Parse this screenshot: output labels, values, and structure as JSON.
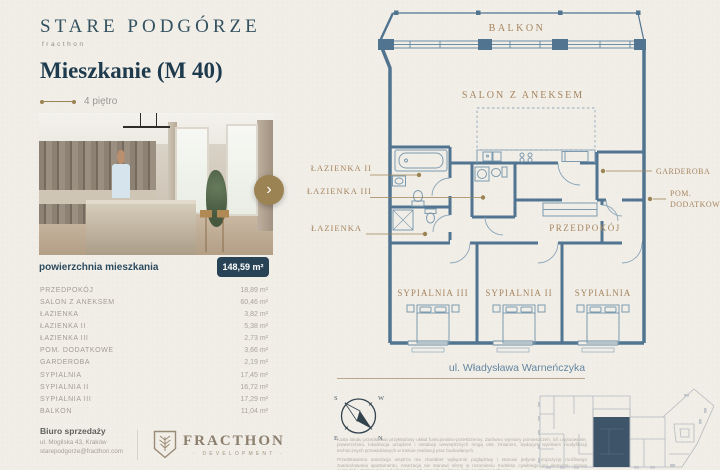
{
  "brand": {
    "name": "STARE PODGÓRZE",
    "sub": "fracthon"
  },
  "header": {
    "title": "Mieszkanie (M 40)",
    "floor": "4 piętro"
  },
  "gallery": {
    "next_icon": "›"
  },
  "area_summary": {
    "label": "powierzchnia mieszkania",
    "value": "148,59 m²"
  },
  "rooms": [
    {
      "name": "PRZEDPOKÓJ",
      "area": "18,89 m²"
    },
    {
      "name": "SALON Z ANEKSEM",
      "area": "60,46 m²"
    },
    {
      "name": "ŁAZIENKA",
      "area": "3,82 m²"
    },
    {
      "name": "ŁAZIENKA II",
      "area": "5,38 m²"
    },
    {
      "name": "ŁAZIENKA III",
      "area": "2,73 m²"
    },
    {
      "name": "POM. DODATKOWE",
      "area": "3,66 m²"
    },
    {
      "name": "GARDEROBA",
      "area": "2,19 m²"
    },
    {
      "name": "SYPIALNIA",
      "area": "17,45 m²"
    },
    {
      "name": "SYPIALNIA II",
      "area": "16,72 m²"
    },
    {
      "name": "SYPIALNIA III",
      "area": "17,29 m²"
    },
    {
      "name": "BALKON",
      "area": "11,04 m²"
    }
  ],
  "office": {
    "title": "Biuro sprzedaży",
    "address": "ul. Mogilska 43, Kraków",
    "email": "starepodgorze@fracthon.com"
  },
  "developer": {
    "name": "FRACTHON",
    "sub": "DEVELOPMENT"
  },
  "plan": {
    "balkon": "BALKON",
    "salon": "SALON Z ANEKSEM",
    "lazienka2": "ŁAZIENKA II",
    "lazienka3": "ŁAZIENKA III",
    "lazienka": "ŁAZIENKA",
    "garderoba": "GARDEROBA",
    "pom_line1": "POM.",
    "pom_line2": "DODATKOWE",
    "przedpokoj": "PRZEDPOKÓJ",
    "sypialnia3": "SYPIALNIA III",
    "sypialnia2": "SYPIALNIA II",
    "sypialnia": "SYPIALNIA",
    "street": "ul. Władysława Warneńczyka"
  },
  "compass": {
    "n": "N",
    "s": "S",
    "e": "E",
    "w": "W"
  },
  "disclaimer": {
    "p1": "Karta lokalu przedstawia przykładowy układ funkcjonalno-przestrzenny. Zarówno wymiary pomieszczeń, ich usytuowanie, powierzchnia, lokalizacja urządzeń i instalacji wewnętrznych mogą ulec zmianom, będącym wynikiem modyfikacji technicznych przewidzianych w trakcie realizacji prac budowlanych.",
    "p2": "Przedstawiona aranżacja wnętrza ma charakter wyłącznie poglądowy i stanowi jedynie propozycję możliwego zaaranżowania apartamentu. Aranżacja nie stanowi oferty w rozumieniu Kodeksu cywilnego ani elementu umowy sprzedaży. Zakres prac wykończeniowych oraz ich realizacja leżą po stronie nabywcy."
  },
  "colors": {
    "accent_gold": "#9c8354",
    "navy": "#1e3a4d",
    "plan_blue": "#517490",
    "badge_navy": "#294356",
    "unit_highlight": "#3e5468"
  }
}
